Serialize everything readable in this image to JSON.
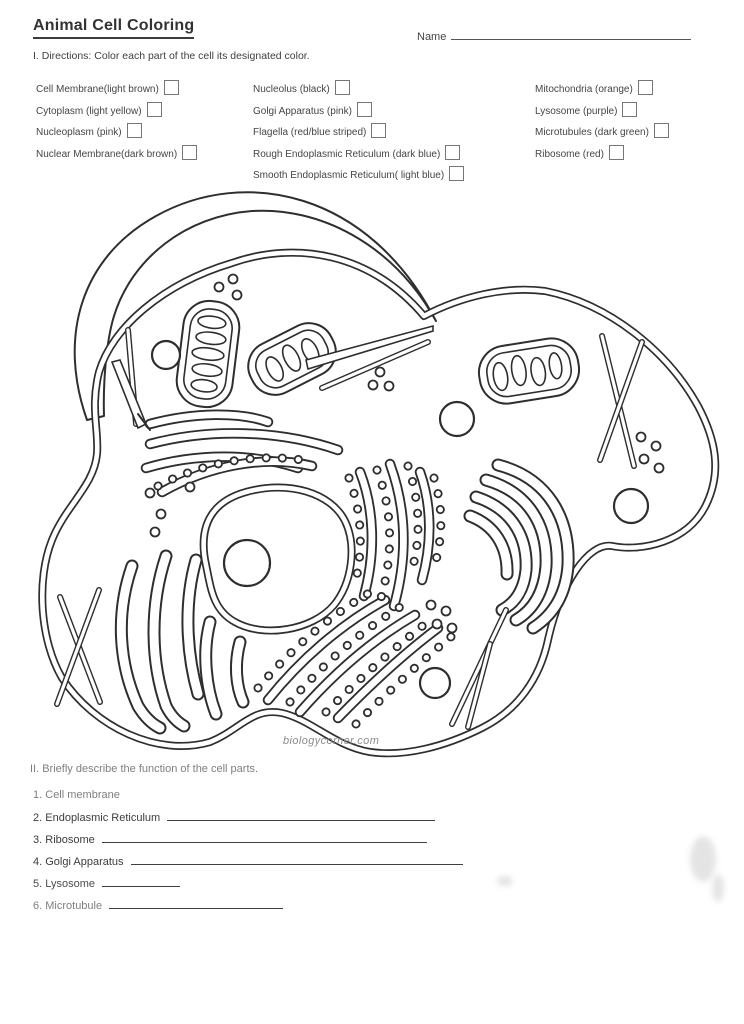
{
  "header": {
    "title": "Animal Cell Coloring",
    "name_label": "Name",
    "directions": "I. Directions: Color each part of the cell its designated color."
  },
  "color_key": {
    "columns": [
      {
        "items": [
          {
            "label": "Cell Membrane(light brown)"
          },
          {
            "label": "Cytoplasm (light yellow)"
          },
          {
            "label": "Nucleoplasm (pink)"
          },
          {
            "label": "Nuclear Membrane(dark brown)"
          }
        ]
      },
      {
        "items": [
          {
            "label": "Nucleolus (black)"
          },
          {
            "label": "Golgi Apparatus (pink)"
          },
          {
            "label": "Flagella (red/blue striped)"
          },
          {
            "label": "Rough Endoplasmic Reticulum (dark blue)"
          },
          {
            "label": "Smooth Endoplasmic Reticulum( light blue)"
          }
        ]
      },
      {
        "items": [
          {
            "label": "Mitochondria (orange)"
          },
          {
            "label": "Lysosome (purple)"
          },
          {
            "label": "Microtubules (dark green)"
          },
          {
            "label": "Ribosome (red)"
          }
        ]
      }
    ]
  },
  "diagram": {
    "watermark": "biologycorner.com"
  },
  "section2": {
    "heading": "II. Briefly describe the function of the cell parts.",
    "questions": [
      {
        "number": "1.",
        "label": "Cell membrane"
      },
      {
        "number": "2.",
        "label": "Endoplasmic Reticulum"
      },
      {
        "number": "3.",
        "label": "Ribosome"
      },
      {
        "number": "4.",
        "label": "Golgi Apparatus"
      },
      {
        "number": "5.",
        "label": "Lysosome"
      },
      {
        "number": "6.",
        "label": "Microtubule"
      }
    ]
  },
  "colors": {
    "ink": "#3a3a3a",
    "faded_ink": "#5e5e5e",
    "line_art": "#2e2e2e",
    "watermark": "#8c8c8c"
  }
}
